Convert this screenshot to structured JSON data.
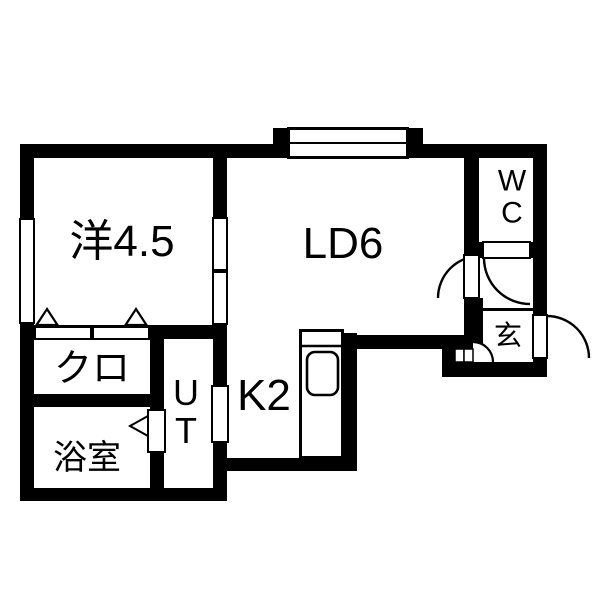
{
  "floorplan": {
    "kind": "japanese-apartment-floor-plan",
    "colors": {
      "wall": "#000000",
      "floor": "#ffffff",
      "background": "#ffffff",
      "line": "#000000"
    },
    "rooms": [
      {
        "id": "western-room",
        "label": "洋4.5",
        "meaning": "Western-style room 4.5 mats"
      },
      {
        "id": "living-dining",
        "label": "LD6",
        "meaning": "Living-Dining 6 mats"
      },
      {
        "id": "kitchen",
        "label": "K2",
        "meaning": "Kitchen 2 mats"
      },
      {
        "id": "closet",
        "label": "クロ",
        "meaning": "Closet"
      },
      {
        "id": "bathroom",
        "label": "浴室",
        "meaning": "Bathroom"
      },
      {
        "id": "utility",
        "label": "UT",
        "meaning": "Utility / washroom"
      },
      {
        "id": "toilet",
        "label": "WC",
        "meaning": "Toilet"
      },
      {
        "id": "entrance",
        "label": "玄",
        "meaning": "Genkan entrance"
      }
    ],
    "symbols": [
      "window-top",
      "window-left",
      "sliding-door-western-ld",
      "closet-sliding-doors",
      "closet-marker-triangles",
      "bathroom-door-marker",
      "utility-door-opening",
      "ld-hall-door-swing",
      "wc-door-swing",
      "entrance-door-swing",
      "entry-step-arc",
      "entry-step-blocks",
      "kitchen-counter-sink",
      "hall-step-line"
    ]
  }
}
